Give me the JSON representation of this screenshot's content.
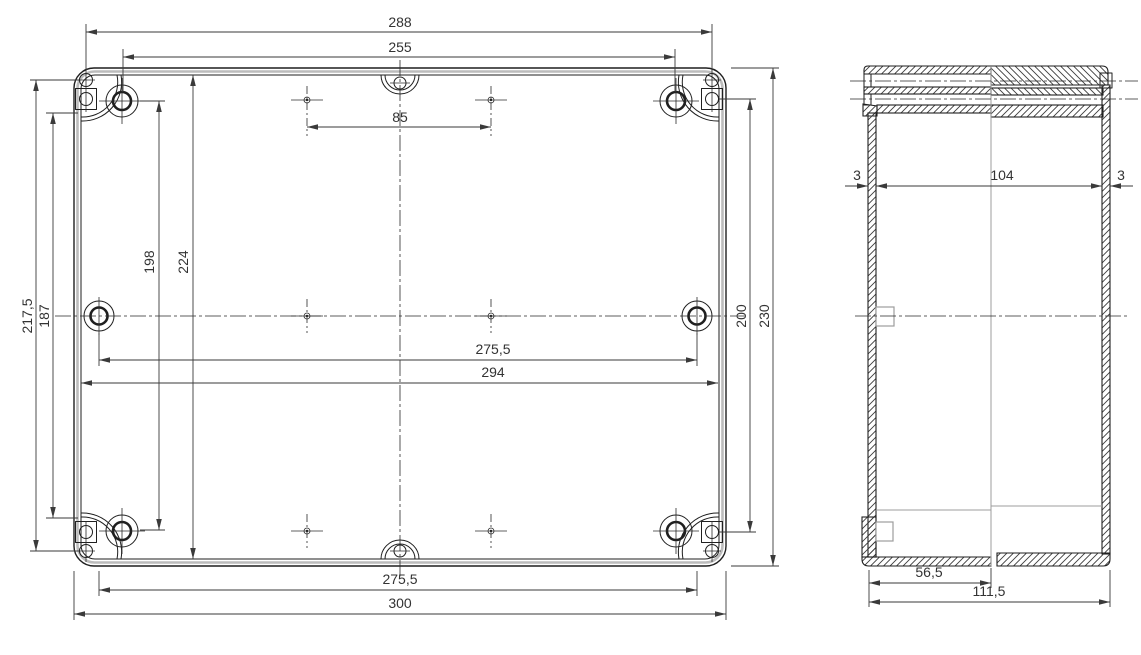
{
  "top_view": {
    "dim_288": "288",
    "dim_255": "255",
    "dim_85": "85",
    "dim_217_5": "217,5",
    "dim_187": "187",
    "dim_198": "198",
    "dim_224": "224",
    "dim_200": "200",
    "dim_230": "230",
    "dim_275_5_mid": "275,5",
    "dim_294": "294",
    "dim_275_5_bottom": "275,5",
    "dim_300": "300"
  },
  "side_view": {
    "dim_3_left": "3",
    "dim_104": "104",
    "dim_3_right": "3",
    "dim_56_5": "56,5",
    "dim_111_5": "111,5"
  },
  "colors": {
    "line": "#1f1f1f",
    "dimension_text": "#333333",
    "shade": "#bcbcbc"
  }
}
